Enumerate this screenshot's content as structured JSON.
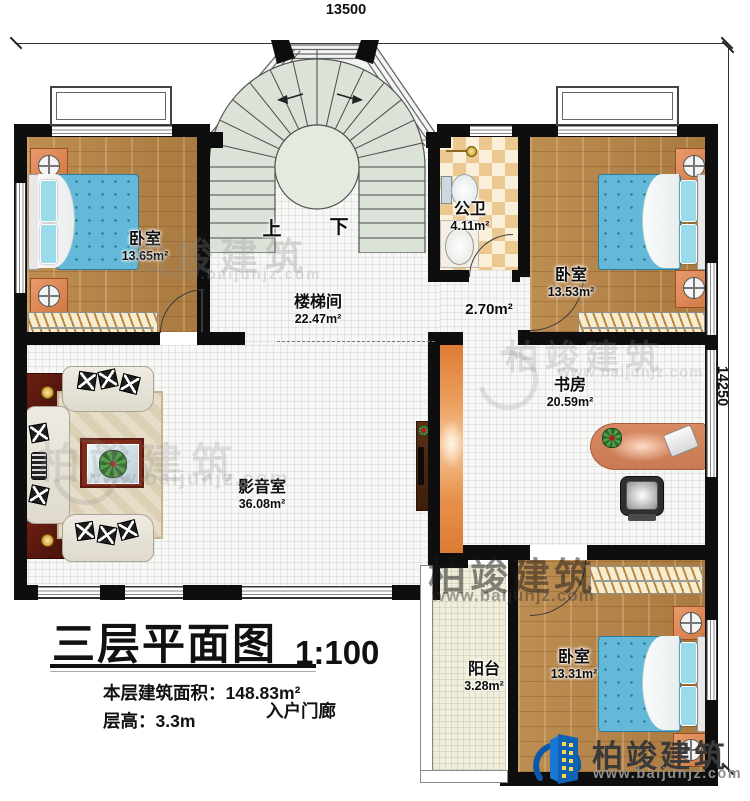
{
  "dimensions": {
    "top": "13500",
    "right": "14250"
  },
  "rooms": {
    "bedroom1": {
      "name": "卧室",
      "area": "13.65m²"
    },
    "stairwell": {
      "name": "楼梯间",
      "area": "22.47m²"
    },
    "bathroom": {
      "name": "公卫",
      "area": "4.11m²"
    },
    "bedroom2": {
      "name": "卧室",
      "area": "13.53m²"
    },
    "corridor": {
      "area": "2.70m²"
    },
    "study": {
      "name": "书房",
      "area": "20.59m²"
    },
    "media_room": {
      "name": "影音室",
      "area": "36.08m²"
    },
    "balcony": {
      "name": "阳台",
      "area": "3.28m²"
    },
    "bedroom3": {
      "name": "卧室",
      "area": "13.31m²"
    }
  },
  "stairs": {
    "up": "上",
    "down": "下"
  },
  "title": {
    "main": "三层平面图",
    "scale": "1:100",
    "area_label": "本层建筑面积：",
    "area_value": "148.83m²",
    "height_label": "层高：",
    "height_value": "3.3m",
    "porch_label": "入户门廊"
  },
  "brand": {
    "name": "柏竣建筑",
    "url": "www.baijunjz.com"
  }
}
